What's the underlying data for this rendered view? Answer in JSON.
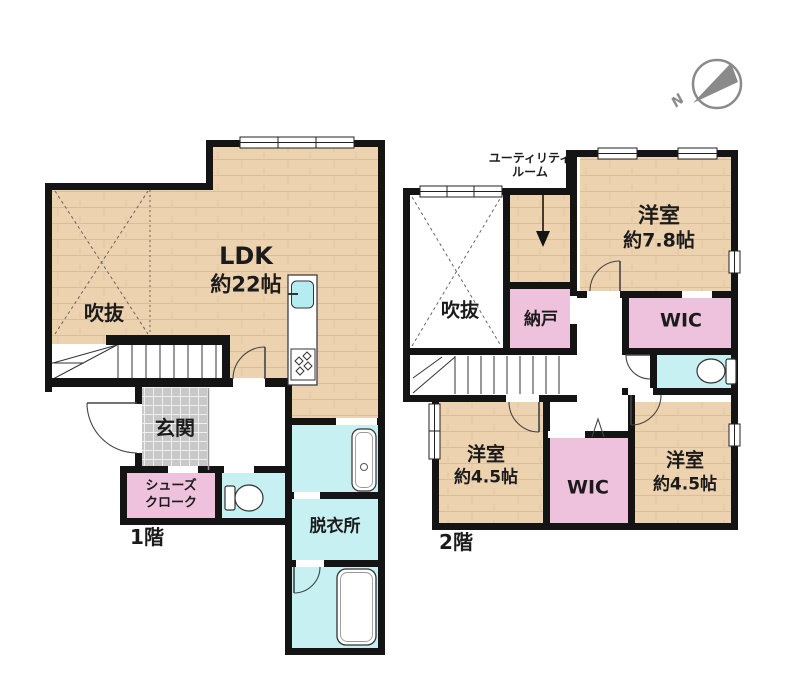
{
  "title": "間取り図",
  "compass": {
    "label": "N"
  },
  "colors": {
    "wall": "#141414",
    "floor_wood": "#ecd2af",
    "room_pink": "#eec1dc",
    "room_cyan": "#c7f0f2",
    "tile_gray": "#c8c8c8",
    "sink_cyan": "#b5ecf2",
    "compass_gray": "#8a8a8a"
  },
  "floor1": {
    "label": "1階",
    "ldk": {
      "name": "LDK",
      "size": "約22帖"
    },
    "void": {
      "name": "吹抜"
    },
    "entrance": {
      "name": "玄関"
    },
    "shoe_closet": {
      "line1": "シューズ",
      "line2": "クローク"
    },
    "dressing_room": {
      "name": "脱衣所"
    }
  },
  "floor2": {
    "label": "2階",
    "utility_room": {
      "line1": "ユーティリティ",
      "line2": "ルーム"
    },
    "bedroom_main": {
      "name": "洋室",
      "size": "約7.8帖"
    },
    "void": {
      "name": "吹抜"
    },
    "storage": {
      "name": "納戸"
    },
    "wic_upper": {
      "name": "WIC"
    },
    "bedroom_left": {
      "name": "洋室",
      "size": "約4.5帖"
    },
    "wic_lower": {
      "name": "WIC"
    },
    "bedroom_right": {
      "name": "洋室",
      "size": "約4.5帖"
    }
  }
}
